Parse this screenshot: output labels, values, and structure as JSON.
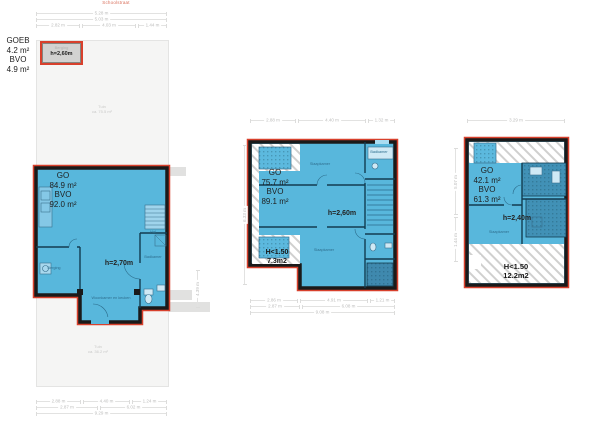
{
  "site_plan": {
    "scale_note": "Schoolstraat",
    "top_dims": {
      "row1": "5.28 m",
      "row2": "5.03 m",
      "row3": [
        "2.82 m",
        "4.03 m",
        "1.44 m"
      ]
    },
    "outside_label": [
      "GOEB",
      "4.2 m²",
      "BVO",
      "4.9 m²"
    ],
    "shed": {
      "room": "Berging",
      "height": "h=2,60m"
    },
    "garden_top": {
      "name": "Tuin",
      "area": "ca. 75.5 m²"
    },
    "garden_bottom": {
      "name": "Tuin",
      "area": "ca. 36.2 m²"
    },
    "bottom_dims": {
      "row1": [
        "2.88 m",
        "4.40 m",
        "1.24 m"
      ],
      "row2": [
        "2.87 m",
        "6.02 m"
      ],
      "row3": "9.29 m"
    },
    "side_dim": "4.39 m"
  },
  "ground_floor": {
    "area_label": [
      "GO",
      "84.9 m²",
      "BVO",
      "92.0 m²"
    ],
    "ceiling_height": "h=2,70m",
    "rooms": {
      "storage": "Berging",
      "living": "Woonkamer en keuken",
      "bath": "Badkamer",
      "hall": "Hal"
    }
  },
  "first_floor": {
    "top_dims": [
      "2.88 m",
      "4.40 m",
      "1.32 m"
    ],
    "area_label": [
      "GO",
      "75.7 m²",
      "BVO",
      "89.1 m²"
    ],
    "ceiling_height": "h=2,60m",
    "low_height": [
      "H<1.50",
      "7.3m2"
    ],
    "rooms": {
      "bedroom_1": "Slaapkamer",
      "bedroom_2": "Slaapkamer",
      "bath": "Badkamer"
    },
    "bottom_dims": {
      "row1": [
        "2.86 m",
        "4.91 m",
        "1.21 m"
      ],
      "row2": [
        "2.87 m",
        "6.08 m"
      ],
      "row3": "9.08 m"
    },
    "side_dim": "6.33 m"
  },
  "second_floor": {
    "top_dim": "3.29 m",
    "area_label": [
      "GO",
      "42.1 m²",
      "BVO",
      "61.3 m²"
    ],
    "ceiling_height": "h=2,40m",
    "low_height": [
      "H<1.50",
      "12.2m2"
    ],
    "rooms": {
      "bedroom": "Slaapkamer"
    },
    "side_dims": [
      "5.07 m",
      "1.44 m"
    ]
  },
  "colors": {
    "room_fill": "#58b7dc",
    "room_fill_dark": "#4191b6",
    "wall": "#1a1a1a",
    "wall_outline": "#d8402c",
    "interior_wall": "#123c50",
    "hatch": "#d0d0cf",
    "site_fill": "#f5f5f4",
    "dim_text": "#bdbdbc"
  }
}
